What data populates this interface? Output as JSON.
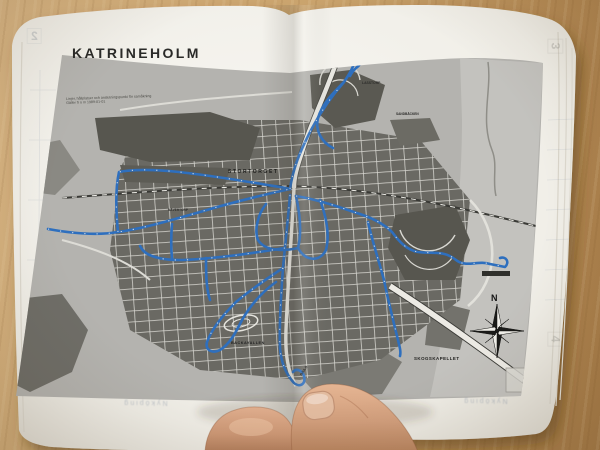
{
  "colors": {
    "wood": "#c9a36d",
    "paper": "#f4f3ef",
    "map_base": "#b4b3af",
    "map_blocks": "#5a5953",
    "bus_route_blue": "#2e6fbe",
    "title_ink": "#2a2a28"
  },
  "booklet": {
    "title": "KATRINEHOLM",
    "caption_line1": "Linjer, hållplatser och anslutningspunkt för samåkning",
    "caption_line2": "Gäller fr o m 1989-01-01",
    "compass_north_label": "N",
    "showthrough_page_number_left": "2",
    "showthrough_page_number_right": "3",
    "showthrough_page_number_bottom": "4",
    "showthrough_footer_text": "Nyköping",
    "map_labels": {
      "stortorget": "STORTORGET",
      "lasstorp": "LASSTORP",
      "sandbacken": "SANDBÄCKEN",
      "navertorp": "NÄVERTORP",
      "backavallen": "BACKAVALLEN",
      "skogskapellet": "SKOGSKAPELLET",
      "djulo": "DJULÖ"
    }
  }
}
